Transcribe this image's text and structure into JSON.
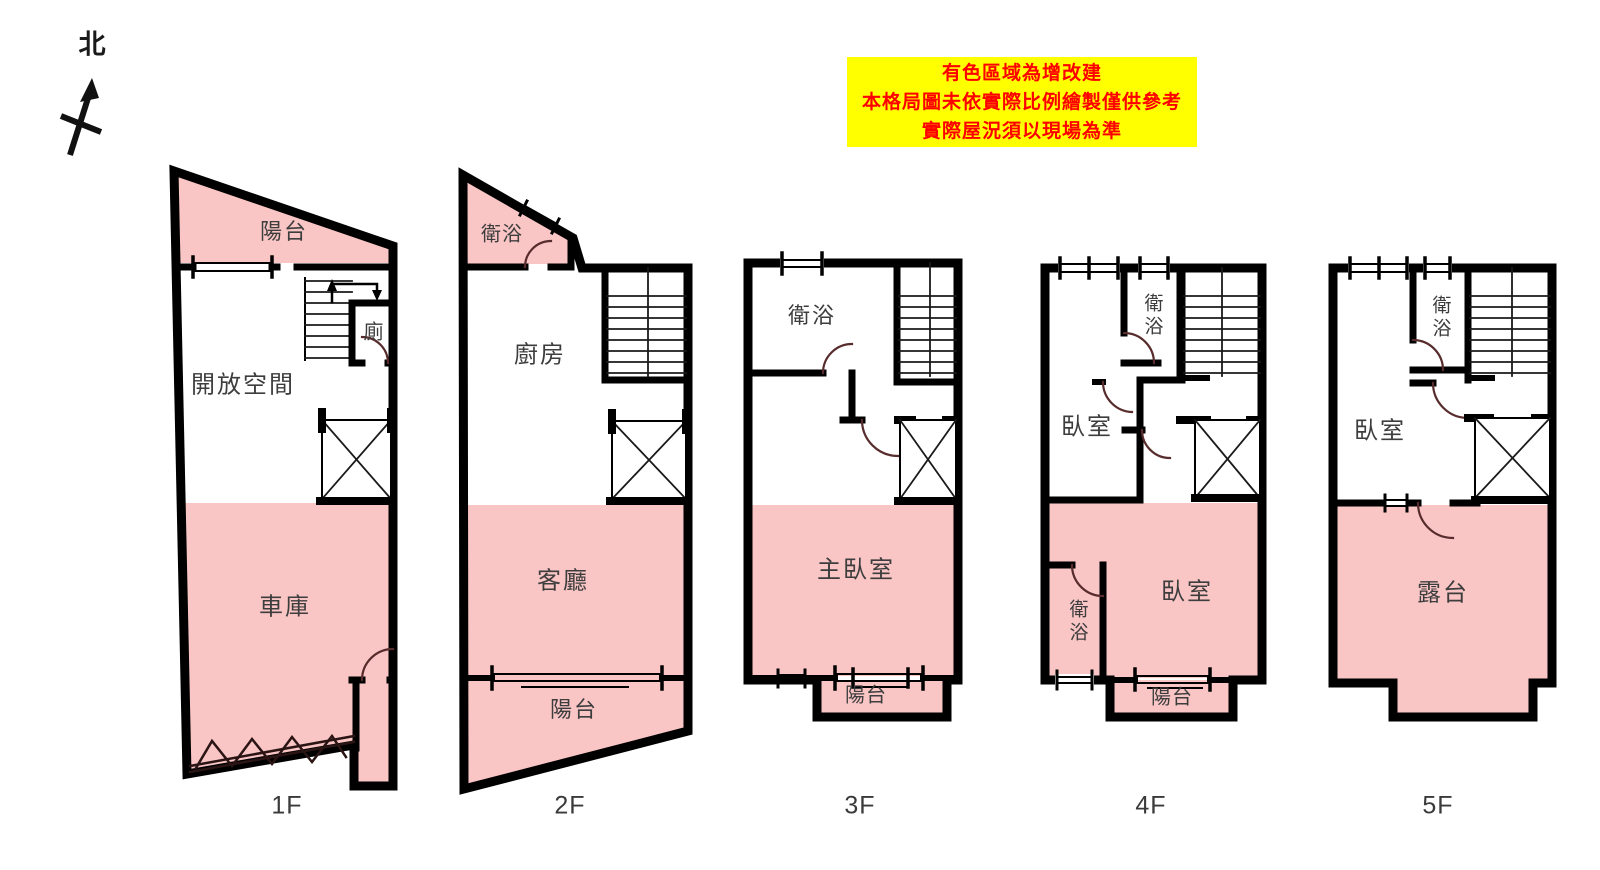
{
  "north_label": "北",
  "notice": {
    "lines": [
      "有色區域為增改建",
      "本格局圖未依實際比例繪製僅供參考",
      "實際屋況須以現場為準"
    ],
    "bg_color": "#ffff00",
    "text_color": "#ff0000"
  },
  "colors": {
    "addition_pink": "#f9c5c5",
    "wall_black": "#000000",
    "door_arc": "#582c2c",
    "label_gray": "#3d3d3d"
  },
  "floors": [
    {
      "name": "1F",
      "rooms": [
        {
          "label": "陽台"
        },
        {
          "label": "開放空間"
        },
        {
          "label": "廁"
        },
        {
          "label": "車庫"
        }
      ]
    },
    {
      "name": "2F",
      "rooms": [
        {
          "label": "衛浴"
        },
        {
          "label": "廚房"
        },
        {
          "label": "客廳"
        },
        {
          "label": "陽台"
        }
      ]
    },
    {
      "name": "3F",
      "rooms": [
        {
          "label": "衛浴"
        },
        {
          "label": "主臥室"
        },
        {
          "label": "陽台"
        }
      ]
    },
    {
      "name": "4F",
      "rooms": [
        {
          "label": "衛浴"
        },
        {
          "label": "臥室"
        },
        {
          "label": "臥室"
        },
        {
          "label": "衛浴"
        },
        {
          "label": "陽台"
        }
      ]
    },
    {
      "name": "5F",
      "rooms": [
        {
          "label": "衛浴"
        },
        {
          "label": "臥室"
        },
        {
          "label": "露台"
        }
      ]
    }
  ]
}
